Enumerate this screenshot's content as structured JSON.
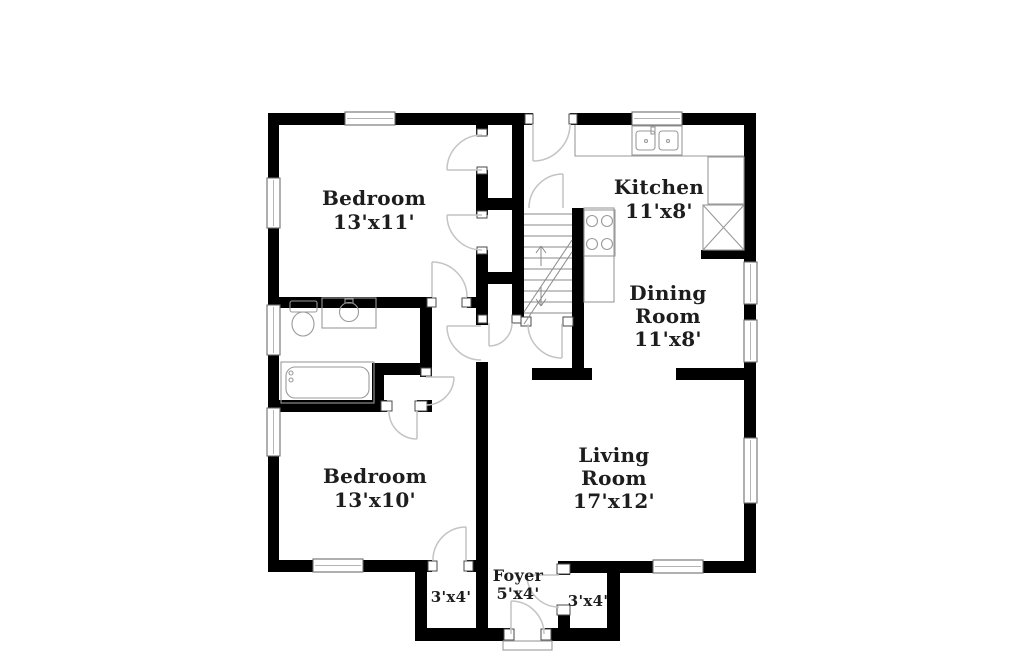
{
  "colors": {
    "background": "#ffffff",
    "walls": "#000000",
    "door_arcs": "#c4c4c4",
    "fixture_lines": "#9a9a9a",
    "label_text": "#1d1d1d"
  },
  "rooms": {
    "bedroom1": {
      "name": "Bedroom",
      "dims": "13'x11'"
    },
    "kitchen": {
      "name": "Kitchen",
      "dims": "11'x8'"
    },
    "dining": {
      "name_line1": "Dining",
      "name_line2": "Room",
      "dims": "11'x8'"
    },
    "living": {
      "name_line1": "Living",
      "name_line2": "Room",
      "dims": "17'x12'"
    },
    "bedroom2": {
      "name": "Bedroom",
      "dims": "13'x10'"
    },
    "foyer": {
      "name": "Foyer",
      "dims": "5'x4'"
    },
    "closet_left": {
      "dims": "3'x4'"
    },
    "closet_right": {
      "dims": "3'x4'"
    }
  }
}
